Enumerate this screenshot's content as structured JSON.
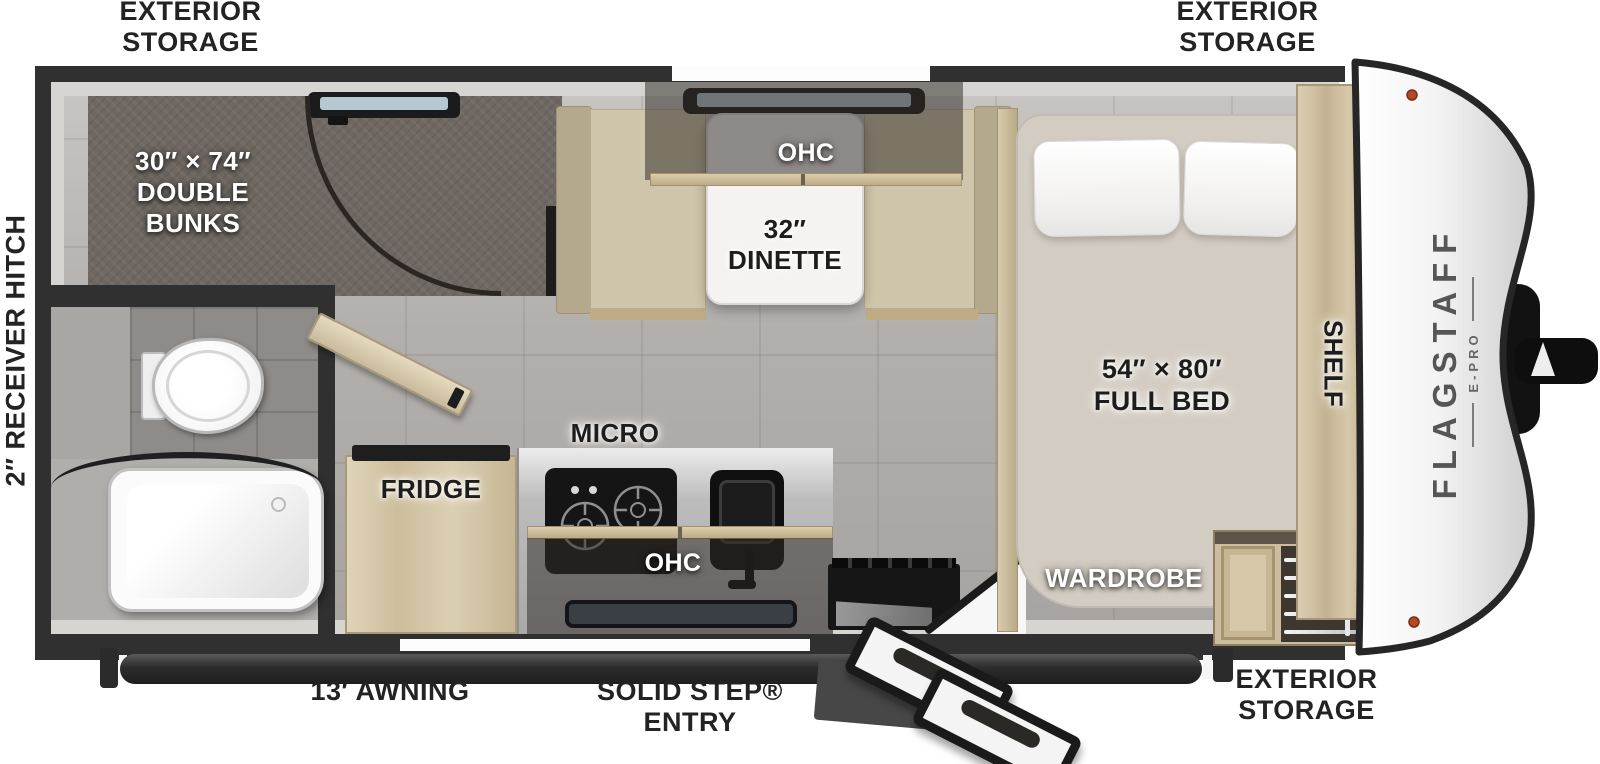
{
  "title": "Flagstaff E-Pro travel trailer floor plan",
  "brand": {
    "name": "FLAGSTAFF",
    "model": "E-PRO"
  },
  "exterior": {
    "storage_line1": "EXTERIOR",
    "storage_line2": "STORAGE",
    "awning": "13′ AWNING",
    "entry_line1": "SOLID STEP®",
    "entry_line2": "ENTRY",
    "hitch": "2″ RECEIVER HITCH"
  },
  "interior": {
    "bunks_line1": "30″ × 74″",
    "bunks_line2": "DOUBLE",
    "bunks_line3": "BUNKS",
    "dinette_line1": "32″",
    "dinette_line2": "DINETTE",
    "dinette_ohc": "OHC",
    "kitchen_ohc": "OHC",
    "micro": "MICRO",
    "fridge": "FRIDGE",
    "bed_line1": "54″ × 80″",
    "bed_line2": "FULL BED",
    "wardrobe": "WARDROBE",
    "shelf": "SHELF"
  },
  "colors": {
    "wall": "#303030",
    "floor": "#aeaba8",
    "carpet": "#6f6862",
    "wood": "#cdbd9c",
    "cushion": "#cfc5aa",
    "marker_light": "#b34a26"
  }
}
